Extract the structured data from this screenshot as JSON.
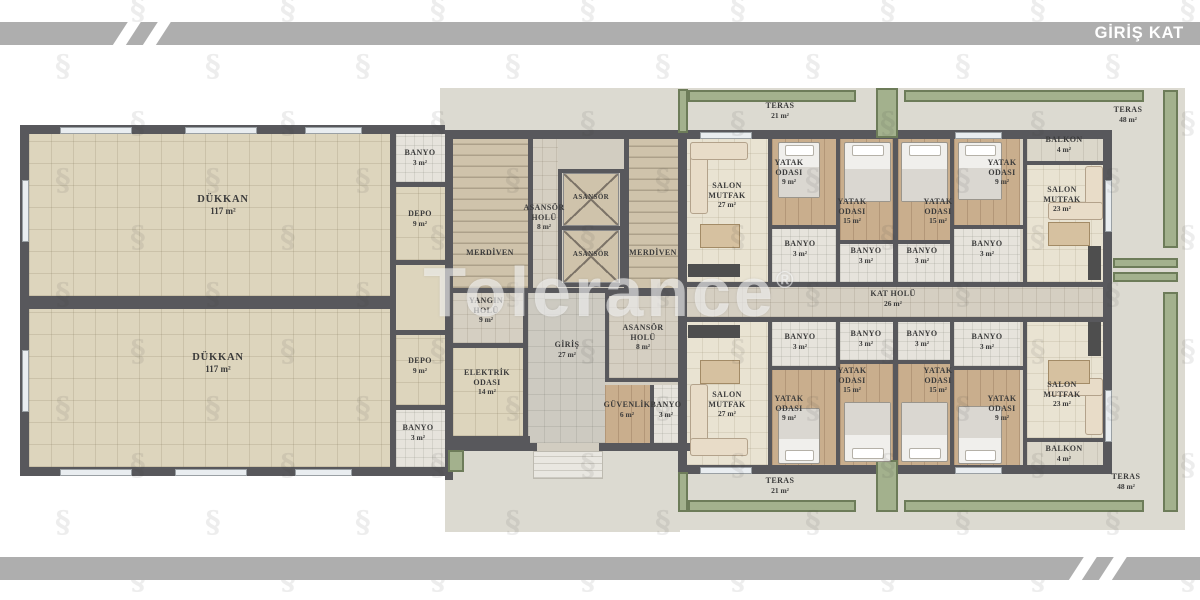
{
  "header": {
    "title": "GİRİŞ KAT"
  },
  "watermark": {
    "text": "Tolerance",
    "reg": "®"
  },
  "colors": {
    "bar_gray": "#aeaeae",
    "wall": "#58585c",
    "planter_green": "#a3b18d",
    "planter_border": "#6d7c59",
    "shop_floor": "#ddd5bd",
    "apartment_floor": "#e9e3d2",
    "bedroom_wood": "#c9ae8d",
    "hall_floor": "#d5cfc2",
    "outdoor_floor": "#dcdad1",
    "label_text": "#3b3b3b"
  },
  "plan": {
    "rooms": [
      {
        "name": "dukkan-1",
        "lines": [
          "DÜKKAN"
        ],
        "area": "117 m²",
        "x": 29,
        "y": 134,
        "w": 361,
        "h": 162,
        "floor": "shop",
        "lx": 223,
        "ly": 194,
        "size": "big"
      },
      {
        "name": "dukkan-2",
        "lines": [
          "DÜKKAN"
        ],
        "area": "117 m²",
        "x": 29,
        "y": 309,
        "w": 361,
        "h": 158,
        "floor": "shop",
        "lx": 218,
        "ly": 352,
        "size": "big"
      },
      {
        "name": "banyo-dukkan-1",
        "lines": [
          "BANYO"
        ],
        "area": "3 m²",
        "x": 396,
        "y": 134,
        "w": 49,
        "h": 48,
        "floor": "bath",
        "lx": 420,
        "ly": 148
      },
      {
        "name": "depo-1",
        "lines": [
          "DEPO"
        ],
        "area": "9 m²",
        "x": 396,
        "y": 187,
        "w": 49,
        "h": 73,
        "floor": "shop",
        "lx": 420,
        "ly": 209
      },
      {
        "name": "depo-2",
        "lines": [
          "DEPO"
        ],
        "area": "9 m²",
        "x": 396,
        "y": 335,
        "w": 49,
        "h": 70,
        "floor": "shop",
        "lx": 420,
        "ly": 356
      },
      {
        "name": "banyo-dukkan-2",
        "lines": [
          "BANYO"
        ],
        "area": "3 m²",
        "x": 396,
        "y": 410,
        "w": 49,
        "h": 57,
        "floor": "bath",
        "lx": 418,
        "ly": 423
      },
      {
        "name": "merdiven-1",
        "lines": [
          "MERDİVEN"
        ],
        "area": null,
        "x": 453,
        "y": 139,
        "w": 75,
        "h": 149,
        "floor": "stairs",
        "lx": 490,
        "ly": 248
      },
      {
        "name": "asansor-holu-1",
        "lines": [
          "ASANSÖR",
          "HOLÜ"
        ],
        "area": "8 m²",
        "x": 528,
        "y": 139,
        "w": 30,
        "h": 149,
        "floor": "hall",
        "lx": 544,
        "ly": 203
      },
      {
        "name": "asansor-1",
        "lines": [
          "ASANSÖR"
        ],
        "area": null,
        "x": 563,
        "y": 173,
        "w": 56,
        "h": 53,
        "floor": "elevator",
        "lx": 591,
        "ly": 193,
        "size": "small"
      },
      {
        "name": "asansor-2",
        "lines": [
          "ASANSÖR"
        ],
        "area": null,
        "x": 563,
        "y": 230,
        "w": 56,
        "h": 53,
        "floor": "elevator",
        "lx": 591,
        "ly": 250,
        "size": "small"
      },
      {
        "name": "merdiven-2",
        "lines": [
          "MERDİVEN"
        ],
        "area": null,
        "x": 629,
        "y": 139,
        "w": 57,
        "h": 151,
        "floor": "stairs",
        "lx": 653,
        "ly": 248
      },
      {
        "name": "yangin-holu",
        "lines": [
          "YANGIN",
          "HOLÜ"
        ],
        "area": "9 m²",
        "x": 453,
        "y": 293,
        "w": 70,
        "h": 50,
        "floor": "hall",
        "lx": 486,
        "ly": 296
      },
      {
        "name": "elektrik-odasi",
        "lines": [
          "ELEKTRİK",
          "ODASI"
        ],
        "area": "14 m²",
        "x": 453,
        "y": 348,
        "w": 70,
        "h": 88,
        "floor": "shop",
        "lx": 487,
        "ly": 368
      },
      {
        "name": "giris",
        "lines": [
          "GİRİŞ"
        ],
        "area": "27 m²",
        "x": 528,
        "y": 293,
        "w": 77,
        "h": 150,
        "floor": "gray",
        "lx": 567,
        "ly": 340
      },
      {
        "name": "asansor-holu-2",
        "lines": [
          "ASANSÖR",
          "HOLÜ"
        ],
        "area": "8 m²",
        "x": 609,
        "y": 296,
        "w": 69,
        "h": 82,
        "floor": "hall",
        "lx": 643,
        "ly": 323
      },
      {
        "name": "guvenlik",
        "lines": [
          "GÜVENLİK"
        ],
        "area": "6 m²",
        "x": 605,
        "y": 385,
        "w": 45,
        "h": 58,
        "floor": "wood",
        "lx": 627,
        "ly": 400
      },
      {
        "name": "banyo-merkez",
        "lines": [
          "BANYO"
        ],
        "area": "3 m²",
        "x": 653,
        "y": 385,
        "w": 28,
        "h": 58,
        "floor": "bath",
        "lx": 666,
        "ly": 400
      },
      {
        "name": "kat-holu",
        "lines": [
          "KAT HOLÜ"
        ],
        "area": "26 m²",
        "x": 686,
        "y": 287,
        "w": 417,
        "h": 30,
        "floor": "hall",
        "lx": 893,
        "ly": 289
      },
      {
        "name": "salon-mutfak-a",
        "lines": [
          "SALON",
          "MUTFAK"
        ],
        "area": "27 m²",
        "x": 686,
        "y": 139,
        "w": 82,
        "h": 143,
        "floor": "cream",
        "lx": 727,
        "ly": 181
      },
      {
        "name": "yatak-odasi-9-a",
        "lines": [
          "YATAK",
          "ODASI"
        ],
        "area": "9 m²",
        "x": 772,
        "y": 139,
        "w": 64,
        "h": 86,
        "floor": "wood",
        "lx": 789,
        "ly": 158
      },
      {
        "name": "banyo-a1",
        "lines": [
          "BANYO"
        ],
        "area": "3 m²",
        "x": 772,
        "y": 229,
        "w": 64,
        "h": 53,
        "floor": "bath",
        "lx": 800,
        "ly": 239
      },
      {
        "name": "yatak-odasi-15-a",
        "lines": [
          "YATAK",
          "ODASI"
        ],
        "area": "15 m²",
        "x": 840,
        "y": 139,
        "w": 53,
        "h": 101,
        "floor": "wood",
        "lx": 852,
        "ly": 197
      },
      {
        "name": "banyo-a2",
        "lines": [
          "BANYO"
        ],
        "area": "3 m²",
        "x": 840,
        "y": 244,
        "w": 53,
        "h": 38,
        "floor": "bath",
        "lx": 866,
        "ly": 246
      },
      {
        "name": "yatak-odasi-15-b",
        "lines": [
          "YATAK",
          "ODASI"
        ],
        "area": "15 m²",
        "x": 898,
        "y": 139,
        "w": 52,
        "h": 101,
        "floor": "wood",
        "lx": 938,
        "ly": 197
      },
      {
        "name": "banyo-b2",
        "lines": [
          "BANYO"
        ],
        "area": "3 m²",
        "x": 898,
        "y": 244,
        "w": 52,
        "h": 38,
        "floor": "bath",
        "lx": 922,
        "ly": 246
      },
      {
        "name": "yatak-odasi-9-b",
        "lines": [
          "YATAK",
          "ODASI"
        ],
        "area": "9 m²",
        "x": 954,
        "y": 139,
        "w": 66,
        "h": 86,
        "floor": "wood",
        "lx": 1002,
        "ly": 158
      },
      {
        "name": "banyo-b1",
        "lines": [
          "BANYO"
        ],
        "area": "3 m²",
        "x": 954,
        "y": 229,
        "w": 66,
        "h": 53,
        "floor": "bath",
        "lx": 987,
        "ly": 239
      },
      {
        "name": "balkon-b",
        "lines": [
          "BALKON"
        ],
        "area": "4 m²",
        "x": 1027,
        "y": 133,
        "w": 76,
        "h": 28,
        "floor": "balkon",
        "lx": 1064,
        "ly": 135
      },
      {
        "name": "salon-mutfak-b",
        "lines": [
          "SALON",
          "MUTFAK"
        ],
        "area": "23 m²",
        "x": 1027,
        "y": 164,
        "w": 76,
        "h": 118,
        "floor": "cream",
        "lx": 1062,
        "ly": 185
      },
      {
        "name": "salon-mutfak-c",
        "lines": [
          "SALON",
          "MUTFAK"
        ],
        "area": "27 m²",
        "x": 686,
        "y": 322,
        "w": 82,
        "h": 143,
        "floor": "cream",
        "lx": 727,
        "ly": 390
      },
      {
        "name": "banyo-c1",
        "lines": [
          "BANYO"
        ],
        "area": "3 m²",
        "x": 772,
        "y": 322,
        "w": 64,
        "h": 44,
        "floor": "bath",
        "lx": 800,
        "ly": 332
      },
      {
        "name": "yatak-odasi-9-c",
        "lines": [
          "YATAK",
          "ODASI"
        ],
        "area": "9 m²",
        "x": 772,
        "y": 370,
        "w": 64,
        "h": 95,
        "floor": "wood",
        "lx": 789,
        "ly": 394
      },
      {
        "name": "banyo-c2",
        "lines": [
          "BANYO"
        ],
        "area": "3 m²",
        "x": 840,
        "y": 322,
        "w": 53,
        "h": 38,
        "floor": "bath",
        "lx": 866,
        "ly": 329
      },
      {
        "name": "yatak-odasi-15-c",
        "lines": [
          "YATAK",
          "ODASI"
        ],
        "area": "15 m²",
        "x": 840,
        "y": 364,
        "w": 53,
        "h": 101,
        "floor": "wood",
        "lx": 852,
        "ly": 366
      },
      {
        "name": "banyo-d2",
        "lines": [
          "BANYO"
        ],
        "area": "3 m²",
        "x": 898,
        "y": 322,
        "w": 52,
        "h": 38,
        "floor": "bath",
        "lx": 922,
        "ly": 329
      },
      {
        "name": "yatak-odasi-15-d",
        "lines": [
          "YATAK",
          "ODASI"
        ],
        "area": "15 m²",
        "x": 898,
        "y": 364,
        "w": 52,
        "h": 101,
        "floor": "wood",
        "lx": 938,
        "ly": 366
      },
      {
        "name": "banyo-d1",
        "lines": [
          "BANYO"
        ],
        "area": "3 m²",
        "x": 954,
        "y": 322,
        "w": 66,
        "h": 44,
        "floor": "bath",
        "lx": 987,
        "ly": 332
      },
      {
        "name": "yatak-odasi-9-d",
        "lines": [
          "YATAK",
          "ODASI"
        ],
        "area": "9 m²",
        "x": 954,
        "y": 370,
        "w": 66,
        "h": 95,
        "floor": "wood",
        "lx": 1002,
        "ly": 394
      },
      {
        "name": "salon-mutfak-d",
        "lines": [
          "SALON",
          "MUTFAK"
        ],
        "area": "23 m²",
        "x": 1027,
        "y": 322,
        "w": 76,
        "h": 116,
        "floor": "cream",
        "lx": 1062,
        "ly": 380
      },
      {
        "name": "balkon-d",
        "lines": [
          "BALKON"
        ],
        "area": "4 m²",
        "x": 1027,
        "y": 441,
        "w": 76,
        "h": 28,
        "floor": "balkon",
        "lx": 1064,
        "ly": 444
      }
    ],
    "outdoor_labels": [
      {
        "name": "teras-ust-sol",
        "lines": [
          "TERAS"
        ],
        "area": "21 m²",
        "lx": 780,
        "ly": 101
      },
      {
        "name": "teras-ust-sag",
        "lines": [
          "TERAS"
        ],
        "area": "48 m²",
        "lx": 1128,
        "ly": 105
      },
      {
        "name": "teras-alt-sol",
        "lines": [
          "TERAS"
        ],
        "area": "21 m²",
        "lx": 780,
        "ly": 476
      },
      {
        "name": "teras-alt-sag",
        "lines": [
          "TERAS"
        ],
        "area": "48 m²",
        "lx": 1126,
        "ly": 472
      }
    ]
  }
}
